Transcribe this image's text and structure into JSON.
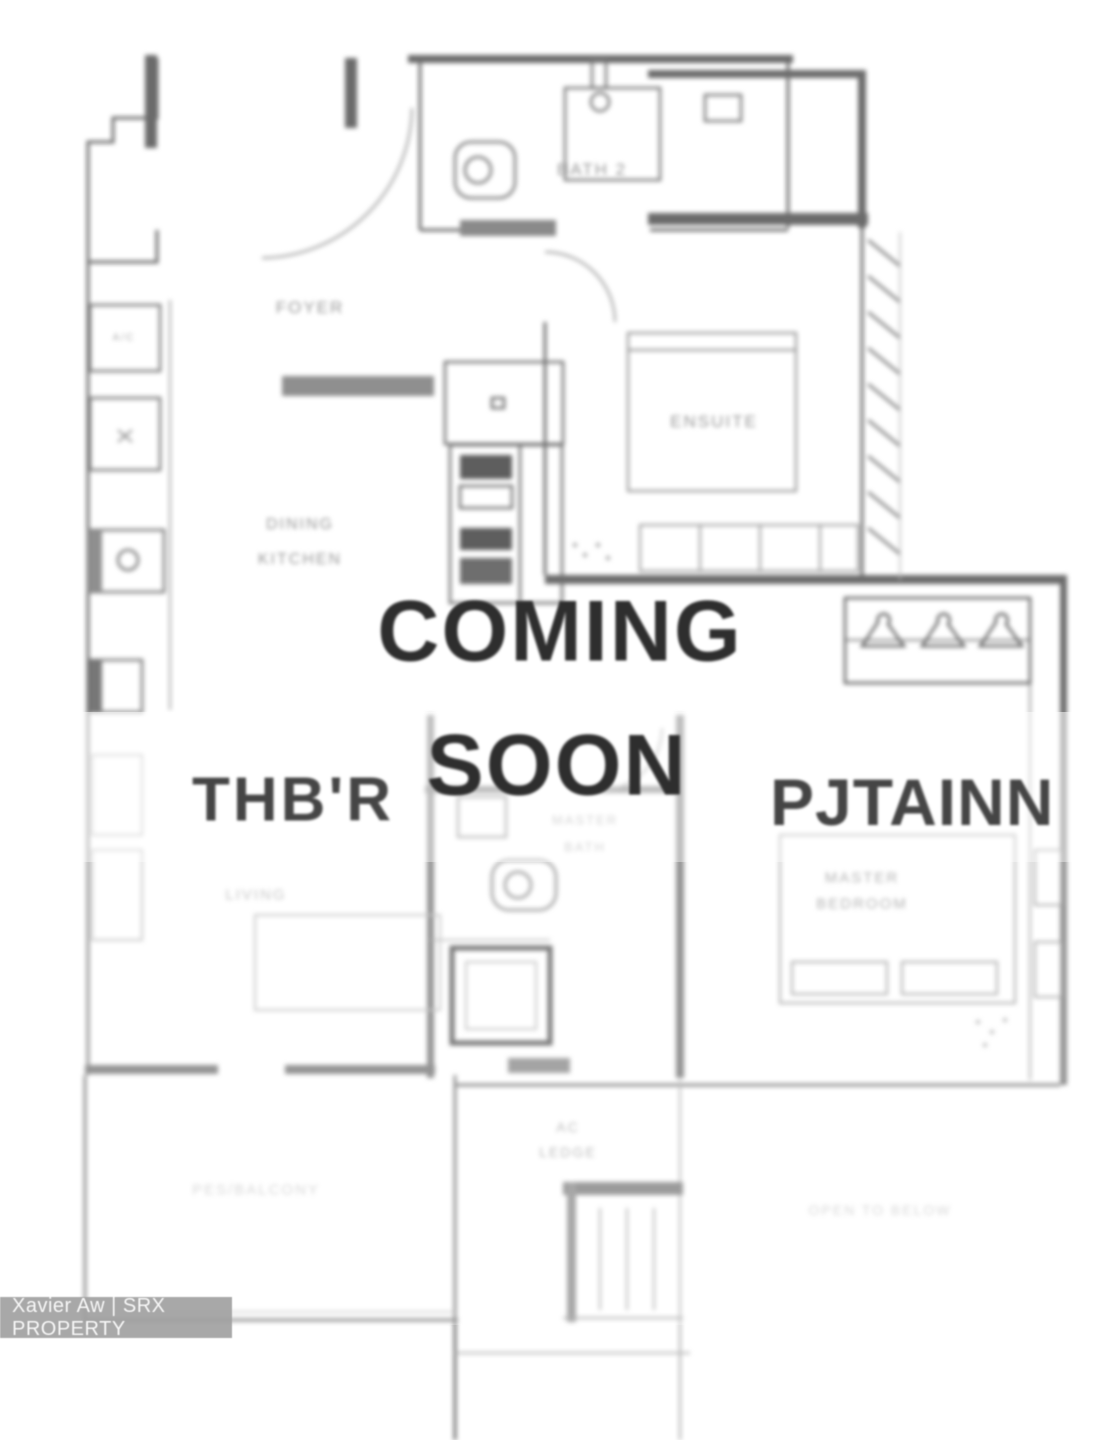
{
  "watermark": {
    "coming_soon_line1": "COMING",
    "coming_soon_line2": "SOON",
    "left_text": "THB'R",
    "right_text": "PJTAINN",
    "agent_badge": "Xavier Aw | SRX PROPERTY"
  },
  "rooms": {
    "bath2": "BATH 2",
    "foyer": "FOYER",
    "ensuite": "ENSUITE",
    "dining_line1": "DINING",
    "dining_line2": "KITCHEN",
    "ac_unit": "A/C",
    "living": "LIVING",
    "master_bath_line1": "MASTER",
    "master_bath_line2": "BATH",
    "master_bedroom_line1": "MASTER",
    "master_bedroom_line2": "BEDROOM",
    "ac_ledge_line1": "AC",
    "ac_ledge_line2": "LEDGE",
    "balcony": "PES/BALCONY",
    "open_to_below": "OPEN TO BELOW"
  },
  "colors": {
    "plan_line": "#6b6b6b",
    "label_text": "#979797",
    "overlay_text": "#2e2e2e",
    "badge_bg": "#9e9e9e",
    "badge_text": "#f7f7f7"
  }
}
